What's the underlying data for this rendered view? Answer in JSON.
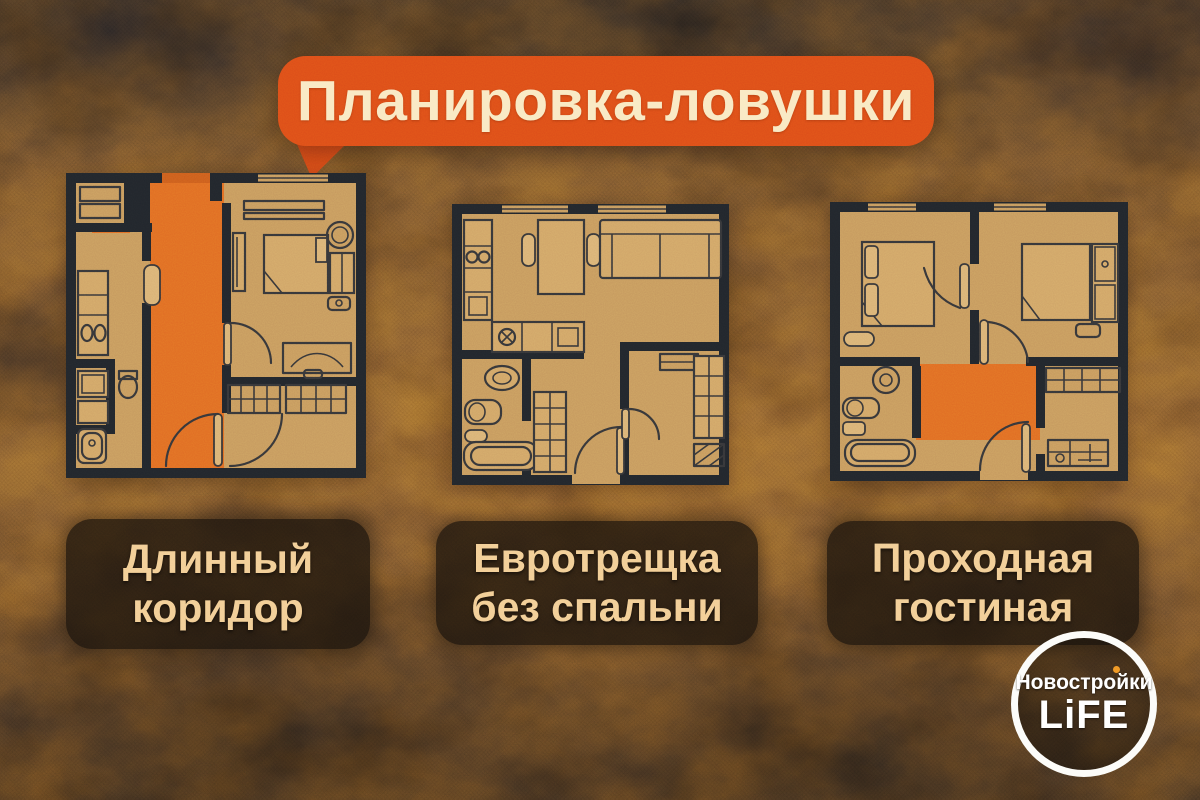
{
  "title": {
    "text": "Планировка-ловушки"
  },
  "plans": [
    {
      "id": "long-corridor",
      "label_lines": [
        "Длинный",
        "коридор"
      ]
    },
    {
      "id": "euro-studio-no-bedroom",
      "label_lines": [
        "Евротрещка",
        "без спальни"
      ]
    },
    {
      "id": "walkthrough-living-room",
      "label_lines": [
        "Проходная",
        "гостиная"
      ]
    }
  ],
  "logo": {
    "line1": "Новостройки",
    "line2": "LiFE"
  },
  "colors": {
    "bubble_orange": "#dd4e19",
    "highlight_orange": "#e4671c",
    "title_text": "#f9e9c4",
    "label_text": "#f2cd97",
    "plan_paper": "#c69a60",
    "plan_wall": "#21262d",
    "logo_dot": "#ef9526"
  }
}
